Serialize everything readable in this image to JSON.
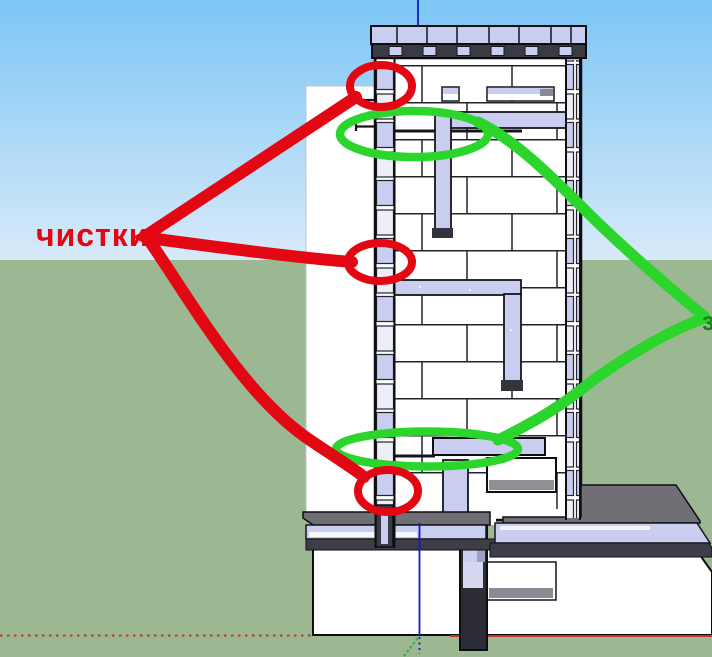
{
  "annotations": {
    "cleanouts_label": "чистки",
    "right_partial_label": "з",
    "red_color": "#e30613",
    "green_color": "#2bd52b",
    "dark_green_color": "#1e7d1e"
  },
  "scene": {
    "sky_top_color": "#7cc6f6",
    "sky_horizon_color": "#d8eaf8",
    "ground_color": "#9bb892",
    "brick_color": "#ffffff",
    "cut_brick_color": "#c9cef0",
    "steel_color": "#34343e",
    "slab_color": "#6f6f75"
  },
  "axes": {
    "red": "#c23327",
    "blue": "#1717c6",
    "green": "#3fae3f"
  }
}
